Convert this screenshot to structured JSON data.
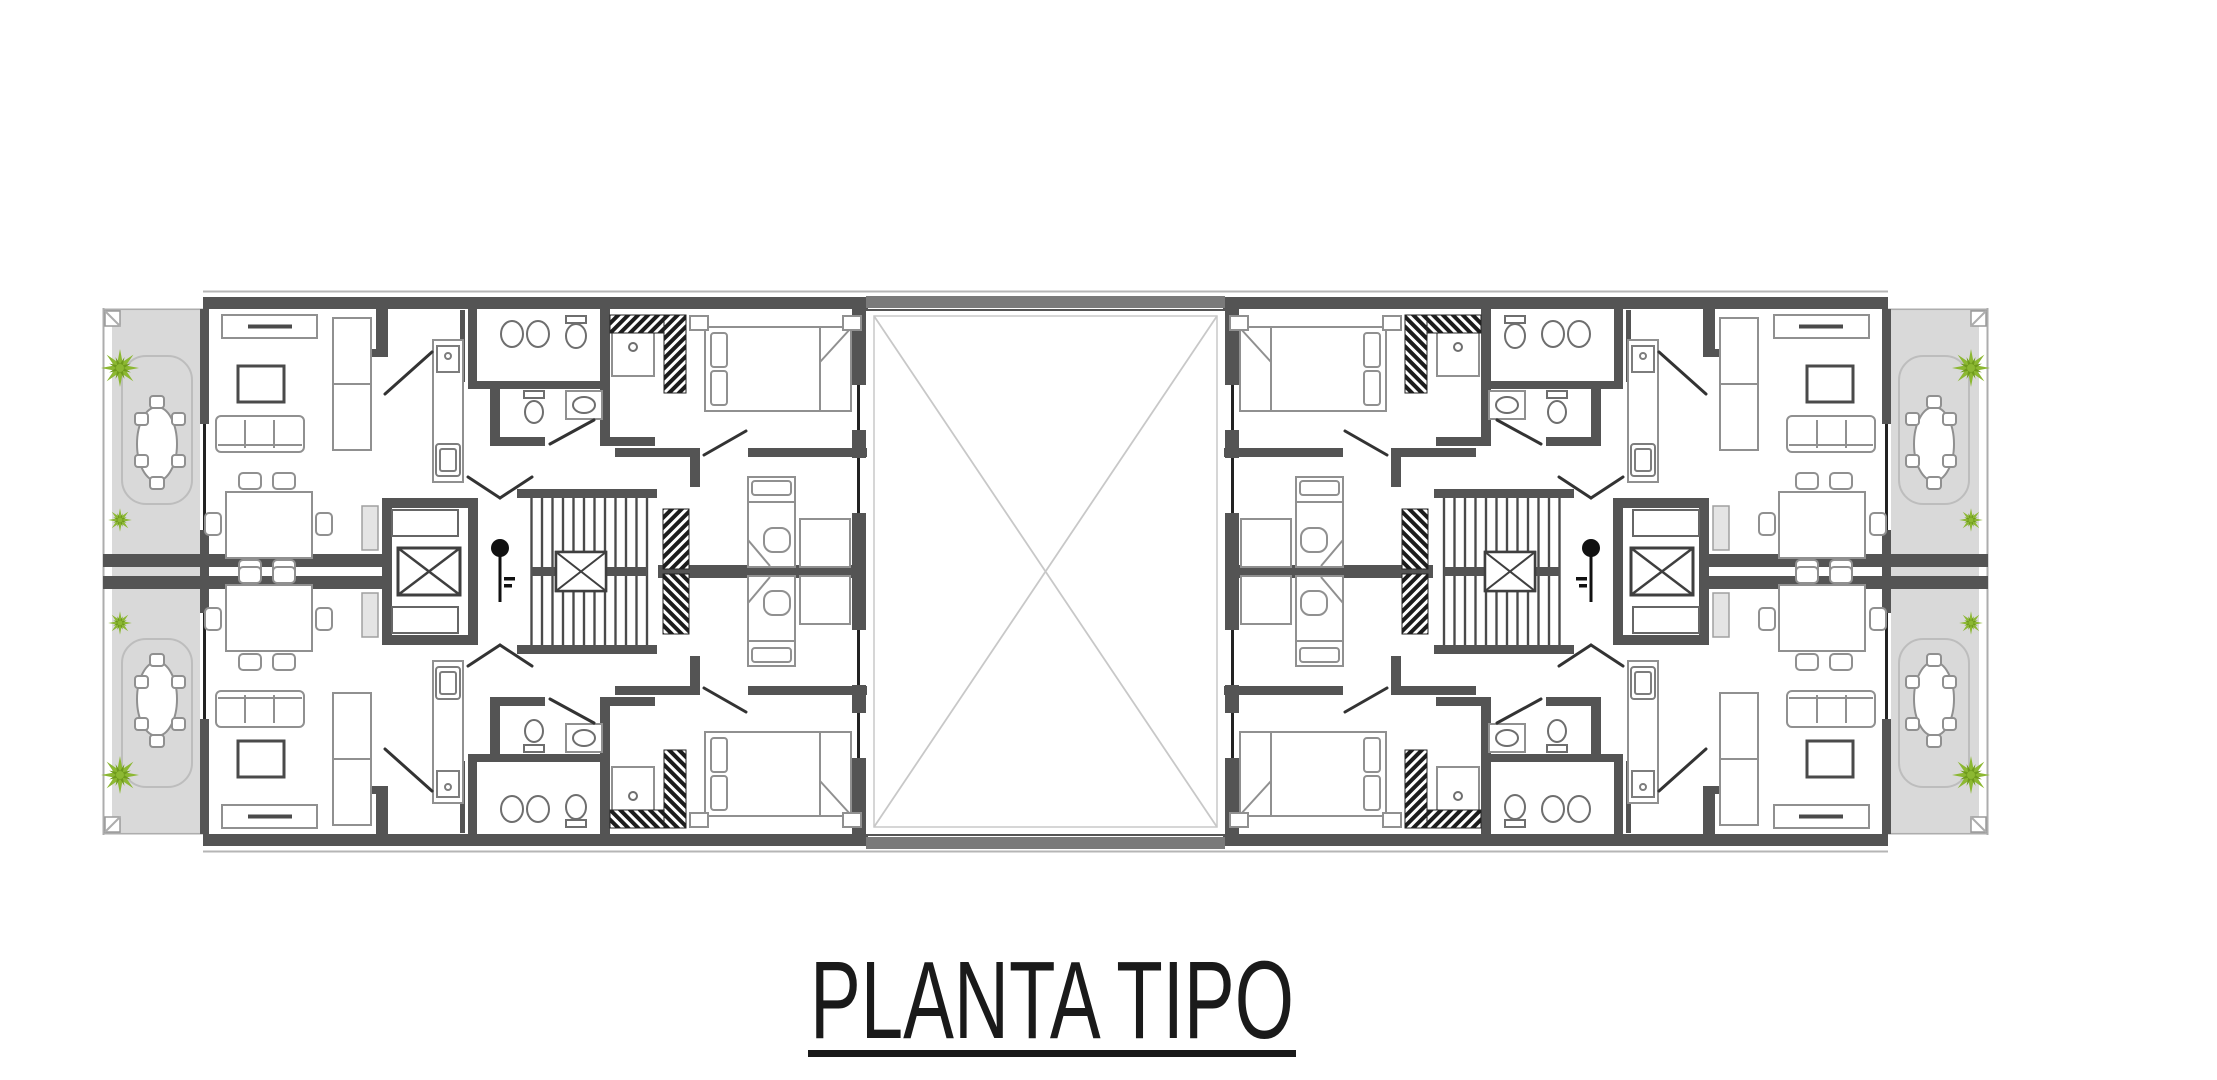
{
  "title": {
    "text": "PLANTA TIPO"
  },
  "colors": {
    "background": "#ffffff",
    "wall": "#545454",
    "wall_light": "#7a7a7a",
    "furniture": "#909090",
    "balcony": "#d9d9d9",
    "glass": "#222222",
    "void_line": "#c8c8c8",
    "plant": "#8cb832",
    "plant_dark": "#6f9a1d",
    "title": "#1a1a1a"
  },
  "icons": [
    "tree-icon",
    "bush-icon",
    "elevator-icon",
    "stairs-icon",
    "section-marker-icon"
  ]
}
